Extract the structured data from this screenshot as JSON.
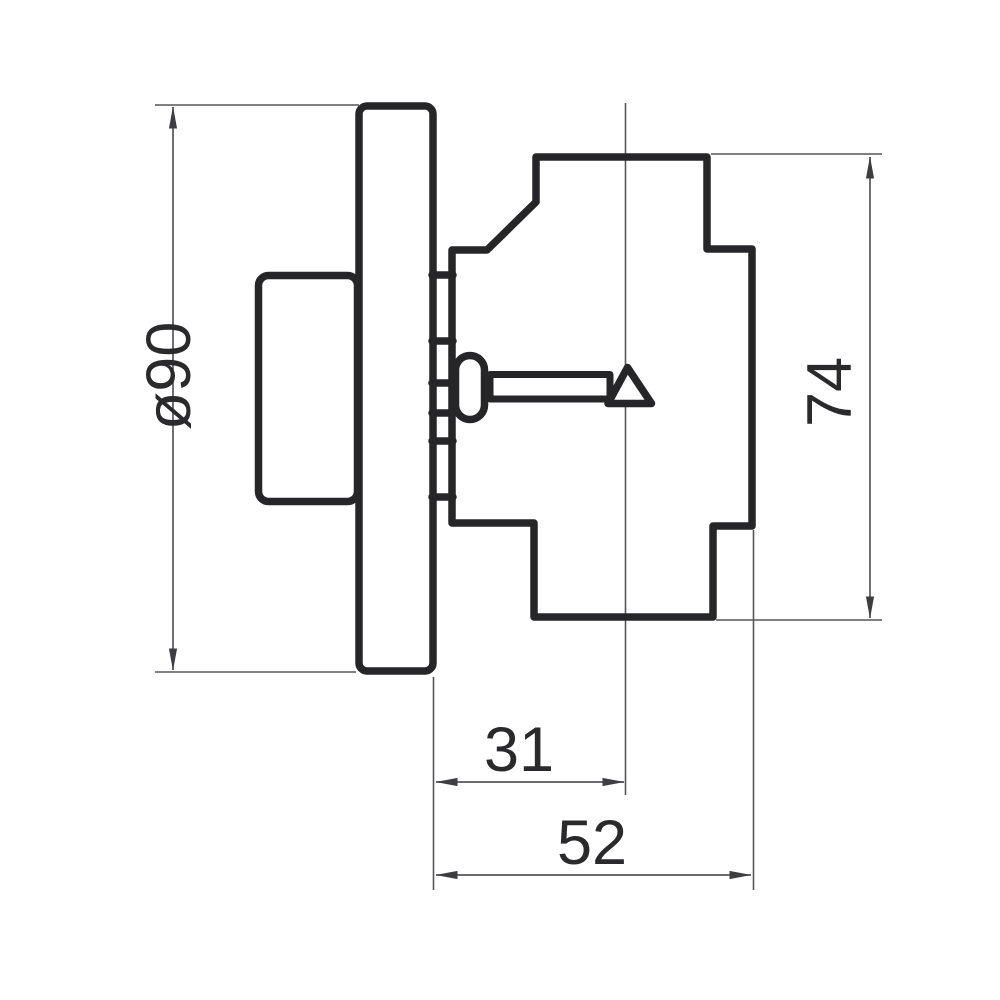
{
  "drawing": {
    "description": "Engineering side-view drawing of a round wall-mounted control device: cover plate with rear box, stepped front body and a central shaft with pointer",
    "view": "side view",
    "colors": {
      "background": "#ffffff",
      "outline": "#262629",
      "dimension_lines": "#55565a",
      "text": "#2a2a2c"
    },
    "parts": [
      "rear box",
      "cover plate",
      "mounting comb",
      "front body",
      "shaft head",
      "shaft stem",
      "pointer triangle",
      "center axis line"
    ]
  },
  "dimensions": [
    {
      "id": "plate-diameter",
      "label": "ø90",
      "value": 90,
      "orientation": "vertical-left"
    },
    {
      "id": "body-height",
      "label": "74",
      "value": 74,
      "orientation": "vertical-right"
    },
    {
      "id": "plate-face-to-axis",
      "label": "31",
      "value": 31,
      "orientation": "horizontal-bottom"
    },
    {
      "id": "plate-face-to-rear",
      "label": "52",
      "value": 52,
      "orientation": "horizontal-bottom"
    }
  ]
}
